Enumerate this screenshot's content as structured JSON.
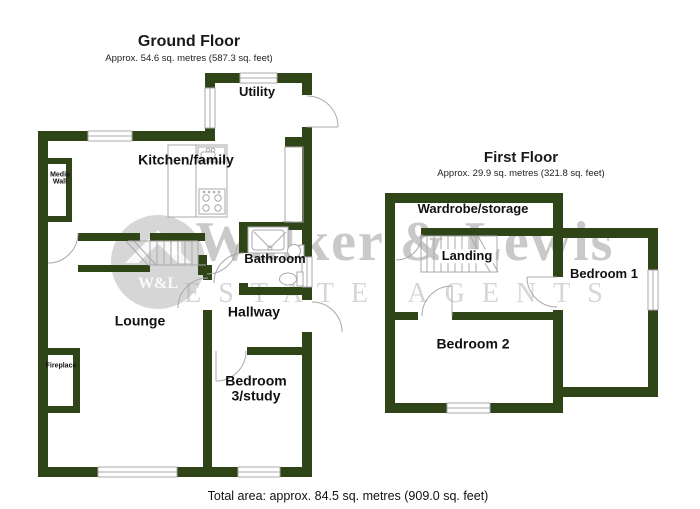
{
  "ground": {
    "title": "Ground Floor",
    "subtitle": "Approx. 54.6 sq. metres (587.3 sq. feet)",
    "rooms": {
      "utility": "Utility",
      "kitchen": "Kitchen/family",
      "bathroom": "Bathroom",
      "hallway": "Hallway",
      "lounge": "Lounge",
      "bedroom3_line1": "Bedroom",
      "bedroom3_line2": "3/study",
      "media_line1": "Media",
      "media_line2": "Wall",
      "fireplace": "Fireplace"
    }
  },
  "first": {
    "title": "First Floor",
    "subtitle": "Approx. 29.9 sq. metres (321.8 sq. feet)",
    "rooms": {
      "wardrobe": "Wardrobe/storage",
      "landing": "Landing",
      "bedroom1": "Bedroom 1",
      "bedroom2": "Bedroom 2"
    }
  },
  "footer": {
    "total": "Total area: approx. 84.5 sq. metres (909.0 sq. feet)"
  },
  "watermark": {
    "brand": "Walker & Lewis",
    "tagline": "ESTATE AGENTS",
    "monogram": "W&L"
  },
  "colors": {
    "wall": "#2f4417",
    "line": "#a9a9a9",
    "label": "#111111",
    "watermark_text": "#c9c9c9",
    "watermark_logo": "#b5b5b5"
  }
}
